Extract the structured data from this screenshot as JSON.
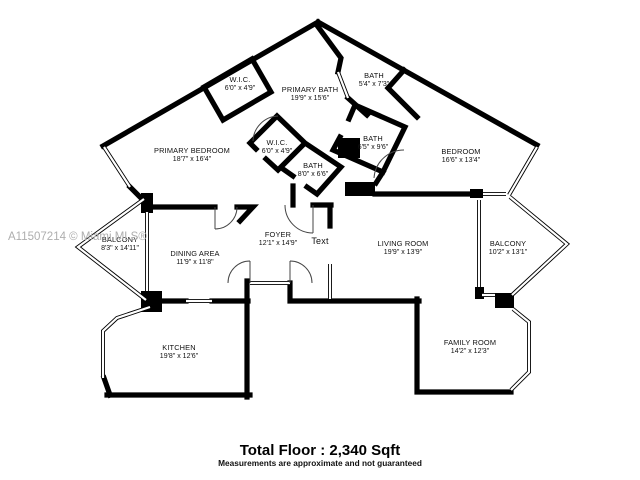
{
  "watermark": {
    "text": "A11507214 © Miami MLS®"
  },
  "colors": {
    "wall": "#000000",
    "label": "#111111",
    "watermark": "#aeaeae",
    "background": "#ffffff"
  },
  "rooms": [
    {
      "name": "W.I.C.",
      "dims": "6'0\" x 4'9\""
    },
    {
      "name": "PRIMARY BATH",
      "dims": "19'9\" x 15'6\""
    },
    {
      "name": "BATH",
      "dims": "5'4\" x 7'3\""
    },
    {
      "name": "PRIMARY BEDROOM",
      "dims": "18'7\" x 16'4\""
    },
    {
      "name": "W.I.C.",
      "dims": "6'0\" x 4'9\""
    },
    {
      "name": "BATH",
      "dims": "8'0\" x 6'6\""
    },
    {
      "name": "BATH",
      "dims": "6'5\" x 9'6\""
    },
    {
      "name": "BEDROOM",
      "dims": "16'6\" x 13'4\""
    },
    {
      "name": "BALCONY",
      "dims": "8'3\" x 14'11\""
    },
    {
      "name": "DINING AREA",
      "dims": "11'9\" x 11'8\""
    },
    {
      "name": "FOYER",
      "dims": "12'1\" x 14'9\""
    },
    {
      "name": "Text",
      "dims": ""
    },
    {
      "name": "LIVING ROOM",
      "dims": "19'9\" x 13'9\""
    },
    {
      "name": "BALCONY",
      "dims": "10'2\" x 13'1\""
    },
    {
      "name": "KITCHEN",
      "dims": "19'8\" x 12'6\""
    },
    {
      "name": "FAMILY ROOM",
      "dims": "14'2\" x 12'3\""
    }
  ],
  "footer": {
    "total": "Total Floor : 2,340 Sqft",
    "disclaimer": "Measurements are approximate and not guaranteed"
  }
}
